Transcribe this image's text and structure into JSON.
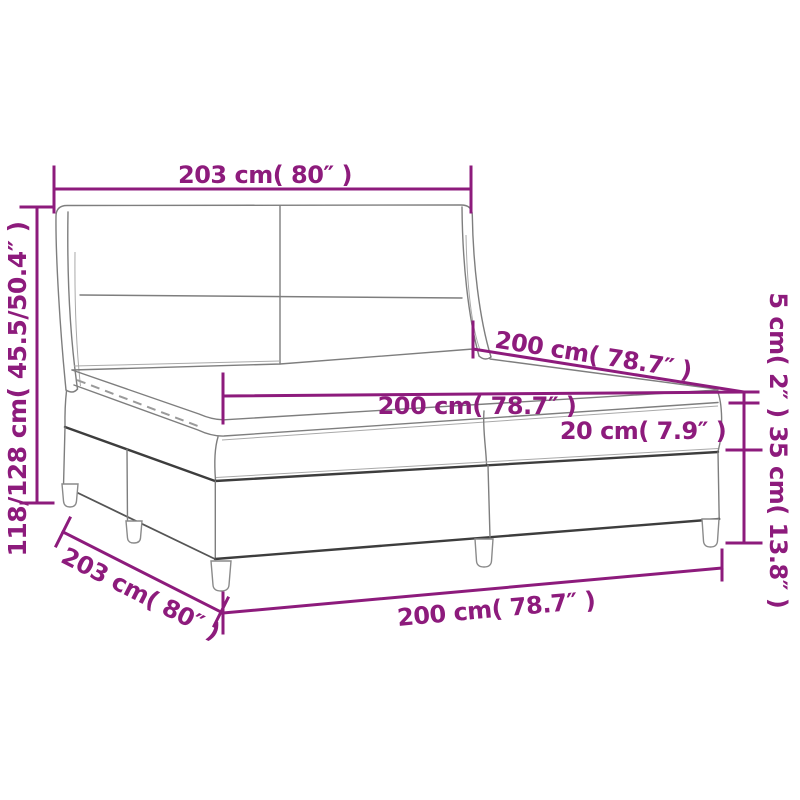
{
  "page": {
    "background": "#ffffff"
  },
  "diagram": {
    "subject": "box spring bed with winged headboard and mattress topper",
    "accent_color": "#8d1b7c",
    "outline_color": "#7e7e7e",
    "dark_outline_color": "#3d3d3d",
    "labels": {
      "headboard_width_top": "203 cm( 80″ )",
      "overall_height_left": "118/128 cm( 45.5/50.4″ )",
      "depth_upper": "200 cm( 78.7″ )",
      "surface_width_middle": "200 cm( 78.7″ )",
      "topper_thickness_right": "5 cm( 2″ )",
      "mattress_thickness": "20 cm( 7.9″ )",
      "base_height_right": "35 cm( 13.8″ )",
      "side_length_bottom": "203 cm( 80″ )",
      "front_width_bottom": "200 cm( 78.7″ )"
    }
  }
}
